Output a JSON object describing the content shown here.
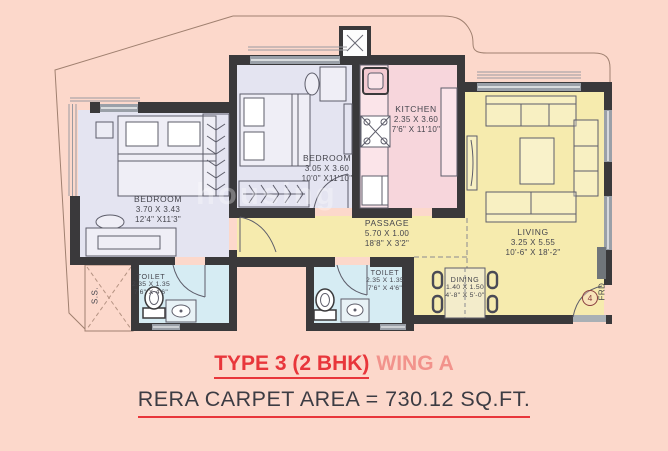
{
  "watermark": "housing",
  "title": {
    "type_label": "TYPE 3 (2 BHK)",
    "wing_label": "WING A",
    "area_label": "RERA CARPET AREA = 730.12 SQ.FT."
  },
  "rooms": {
    "bedroom1": {
      "name": "BEDROOM",
      "metric": "3.70 X 3.43",
      "imperial": "12'4\" X11'3\""
    },
    "bedroom2": {
      "name": "BEDROOM",
      "metric": "3.05 X 3.60",
      "imperial": "10'0\" X11'10\""
    },
    "kitchen": {
      "name": "KITCHEN",
      "metric": "2.35 X 3.60",
      "imperial": "7'6\" X 11'10\""
    },
    "living": {
      "name": "LIVING",
      "metric": "3.25 X 5.55",
      "imperial": "10'-6\" X 18'-2\""
    },
    "passage": {
      "name": "PASSAGE",
      "metric": "5.70 X 1.00",
      "imperial": "18'8\" X 3'2\""
    },
    "toilet1": {
      "name": "TOILET",
      "metric": "2.35 X 1.35",
      "imperial": "7'6\" X 4'6\""
    },
    "toilet2": {
      "name": "TOILET",
      "metric": "2.35 X 1.35",
      "imperial": "7'6\" X 4'6\""
    },
    "dining": {
      "name": "DINING",
      "metric": "1.40 X 1.50",
      "imperial": "4'-8\" X 5'-0\""
    }
  },
  "annotations": {
    "service_shaft": "S.S.",
    "entrance_door_number": "4",
    "entrance_door_type": "FRD"
  },
  "colors": {
    "background": "#fcd8cb",
    "wall": "#3a393b",
    "bedroom_fill": "#e4e4f1",
    "kitchen_fill": "#f7d6dc",
    "living_fill": "#f6ebae",
    "toilet_fill": "#d6ecf3",
    "accent_red": "#e8363b",
    "wing_salmon": "#f2938c",
    "area_text": "#3c3c43"
  }
}
